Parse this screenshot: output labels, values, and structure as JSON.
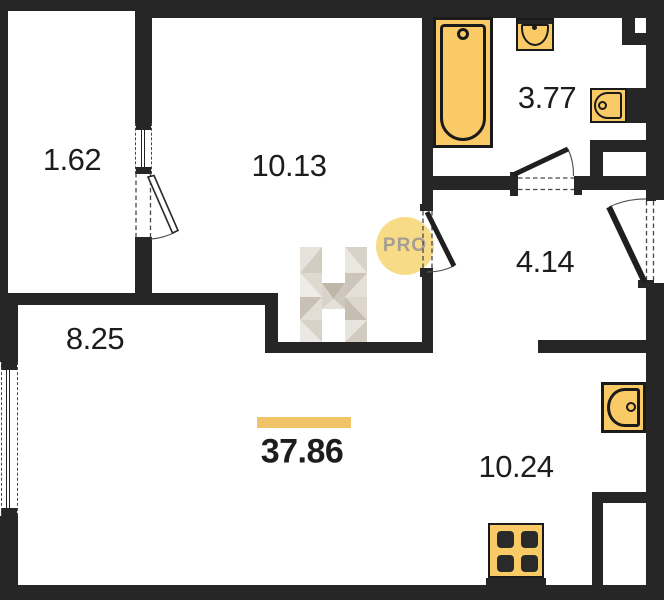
{
  "title": "apartment-floor-plan",
  "watermark": {
    "logo_letter": "H",
    "badge_text": "PRO"
  },
  "labels": {
    "balcony": "1.62",
    "room": "10.13",
    "bathroom": "3.77",
    "hallway": "4.14",
    "kitchen_left": "8.25",
    "kitchen": "10.24",
    "total_area": "37.86"
  },
  "fixtures": [
    "bathtub",
    "bathroom-sink",
    "toilet",
    "kitchen-sink",
    "stove-hob"
  ],
  "colors": {
    "wall": "#262626",
    "fixture_fill": "#F9CA66",
    "fixture_outline": "#1A1A1A",
    "total_highlight_bar": "#F0C469",
    "watermark_badge_fill": "#F8DB87",
    "watermark_badge_text": "#A49E93",
    "label_text": "#1D1D1D"
  }
}
